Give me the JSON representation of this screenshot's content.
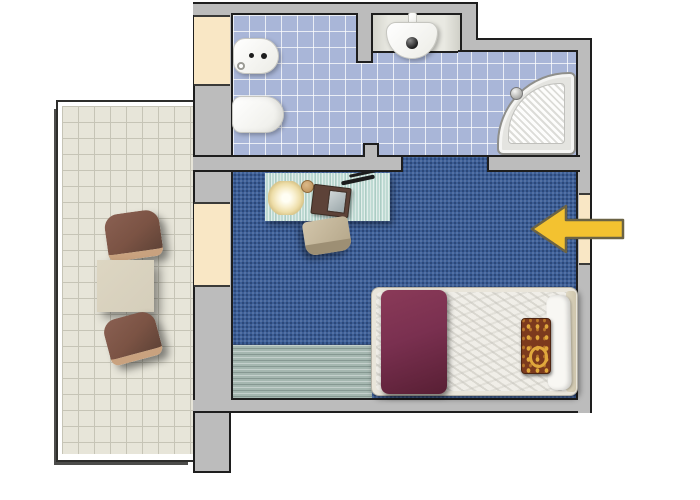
{
  "palette": {
    "wall": "#bcbcbc",
    "wallline": "#1e1e1e",
    "tile": "#a9b6d8",
    "carpet": "#3c5f98",
    "terracetile": "#e7e5d9",
    "terracegrout": "#c6c4b6",
    "door": "#f9e7c5",
    "doorline": "#3a3a38",
    "arrow": "#f3c230",
    "arrowline": "#6b6345",
    "desk": "#bedad3",
    "rug": "#a5b7b0",
    "blanket": "#7a3050",
    "bedframe": "#e9e5da",
    "mattress": "#f0eee8",
    "pillow": "#7c3a1d",
    "pillowgold": "#e0a83c",
    "chairbrown": "#7b5344",
    "chairlip": "#c9a27f",
    "tabletan": "#d5cebb",
    "showerrim": "#e4e4e0"
  },
  "labels": {
    "plan": "apartment floor plan",
    "bathroom": "bathroom with blue tiled floor",
    "bedroom": "bedroom with blue carpet",
    "terrace": "tiled terrace",
    "bidet": "bidet",
    "toilet": "toilet",
    "washbasin": "washbasin",
    "washbasin_niche": "washbasin niche",
    "shower": "corner shower tray",
    "desk": "desk",
    "desk_lamp": "desk lamp",
    "cup": "cup",
    "notebook": "open notebook",
    "pen": "pen",
    "desk_chair": "desk chair",
    "rug": "striped rug",
    "bed": "single bed",
    "blanket": "burgundy blanket",
    "pillow": "patterned pillow",
    "duvet": "folded duvet",
    "headboard": "headboard",
    "terrace_chair_top": "terrace armchair",
    "terrace_chair_bottom": "terrace armchair",
    "terrace_table": "terrace table",
    "door_bathroom": "bathroom entrance door",
    "door_terrace": "terrace door",
    "door_bedroom": "bedroom entrance door",
    "entrance_arrow": "entrance arrow pointing left into bedroom",
    "wall": "wall"
  },
  "annotations": {
    "entrance_arrow": {
      "direction": "left",
      "fill": "#f3c230",
      "outline": "#6b6345"
    }
  }
}
